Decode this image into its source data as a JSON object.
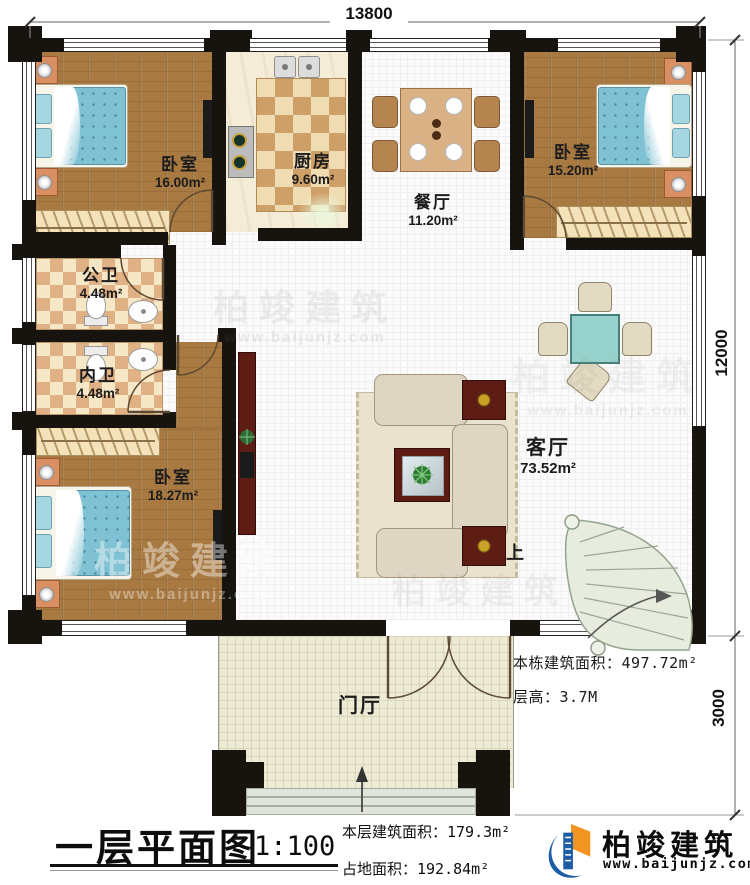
{
  "dimensions": {
    "top_width": "13800",
    "main_height": "12000",
    "porch_height": "3000"
  },
  "rooms": {
    "bedroom_tl": {
      "name": "卧室",
      "area": "16.00m²"
    },
    "kitchen": {
      "name": "厨房",
      "area": "9.60m²"
    },
    "dining": {
      "name": "餐厅",
      "area": "11.20m²"
    },
    "bedroom_tr": {
      "name": "卧室",
      "area": "15.20m²"
    },
    "bath_public": {
      "name": "公卫",
      "area": "4.48m²"
    },
    "bath_private": {
      "name": "内卫",
      "area": "4.48m²"
    },
    "bedroom_bl": {
      "name": "卧室",
      "area": "18.27m²"
    },
    "living": {
      "name": "客厅",
      "area": "73.52m²"
    },
    "foyer": {
      "name": "门厅"
    }
  },
  "annotations": {
    "total_area": "本栋建筑面积：497.72m²",
    "floor_height": "层高：3.7M",
    "stair_up": "上"
  },
  "footer": {
    "title": "一层平面图",
    "scale": "1:100",
    "floor_area": "本层建筑面积：179.3m²",
    "land_area": "占地面积：192.84m²",
    "brand": "柏竣建筑",
    "website": "www.baijunjz.com"
  },
  "watermark": {
    "brand": "柏竣建筑",
    "website": "www.baijunjz.com"
  },
  "colors": {
    "brand_blue": "#1c5ca6",
    "brand_orange": "#f29422",
    "wall": "#17130f",
    "wood": "#a87a42"
  }
}
